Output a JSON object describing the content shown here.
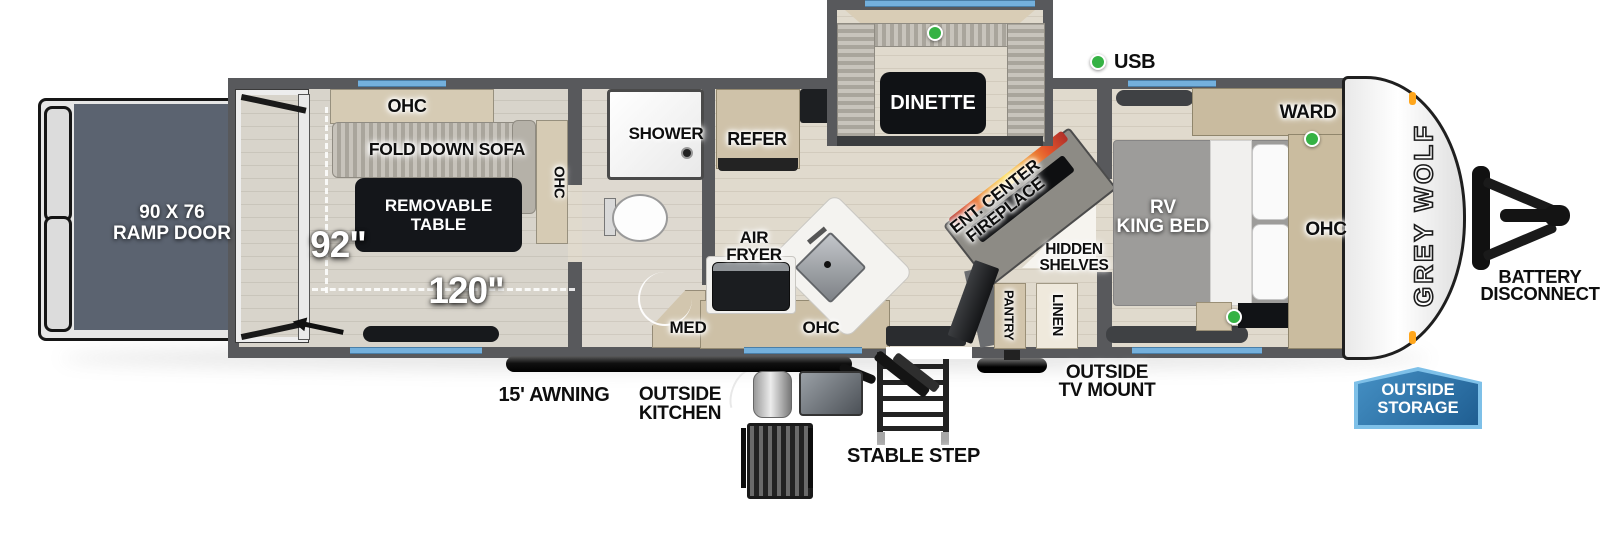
{
  "title": "Grey Wolf toy hauler floorplan",
  "legend": {
    "usb": "USB"
  },
  "garage": {
    "ramp_line1": "90 X 76",
    "ramp_line2": "RAMP DOOR",
    "ohc_top": "OHC",
    "sofa": "FOLD DOWN SOFA",
    "table_line1": "REMOVABLE",
    "table_line2": "TABLE",
    "ohc_side": "OHC",
    "width": "92\"",
    "length": "120\""
  },
  "bath": {
    "shower": "SHOWER",
    "med": "MED"
  },
  "kitchen": {
    "refer": "REFER",
    "air_fryer_line1": "AIR",
    "air_fryer_line2": "FRYER",
    "ohc": "OHC"
  },
  "dinette": {
    "label": "DINETTE"
  },
  "living": {
    "ent_line1": "ENT. CENTER",
    "ent_line2": "FIREPLACE",
    "hidden_line1": "HIDDEN",
    "hidden_line2": "SHELVES",
    "pantry": "PANTRY",
    "linen": "LINEN"
  },
  "bedroom": {
    "bed_line1": "RV",
    "bed_line2": "KING BED",
    "ward": "WARD",
    "ohc": "OHC"
  },
  "exterior": {
    "logo": "GREY WOLF",
    "battery_line1": "BATTERY",
    "battery_line2": "DISCONNECT",
    "storage_line1": "OUTSIDE",
    "storage_line2": "STORAGE",
    "awning": "15' AWNING",
    "outside_kitchen_line1": "OUTSIDE",
    "outside_kitchen_line2": "KITCHEN",
    "stable_step": "STABLE STEP",
    "tv_line1": "OUTSIDE",
    "tv_line2": "TV MOUNT"
  },
  "colors": {
    "wall": "#58595c",
    "floor": "#ddd6ca",
    "window_blue": "#74b0dc",
    "usb_green": "#35b244",
    "ramp_floor": "#5b6370",
    "badge_blue": "#2a6da3",
    "fireplace_orange": "#f3a13a"
  }
}
